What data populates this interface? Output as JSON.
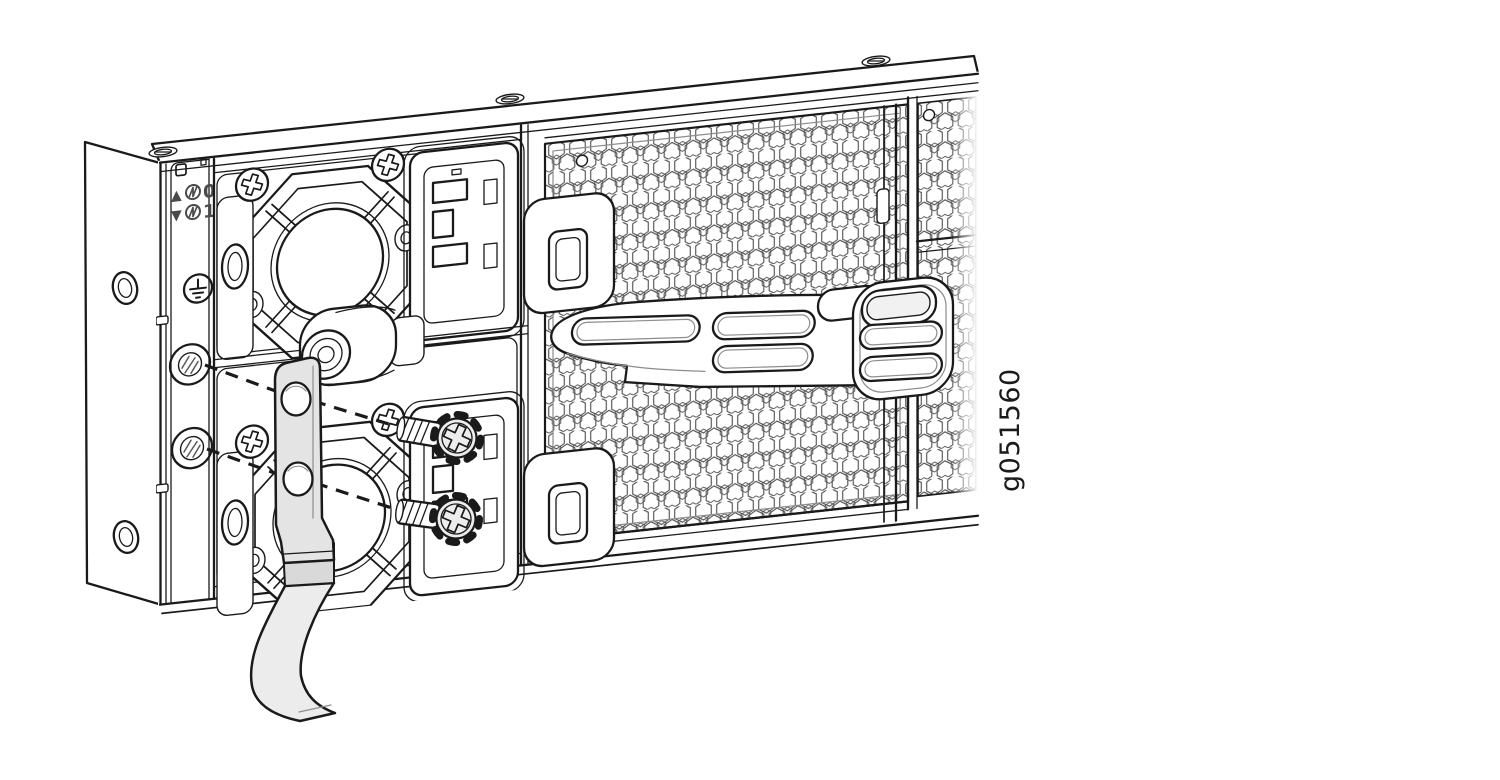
{
  "figure": {
    "graphic_id": "g051560",
    "title": "Chassis rear panel grounding-lug installation illustration",
    "background": "#ffffff"
  },
  "colors": {
    "line": "#1a1a1a",
    "soft_line": "#8d8d8d",
    "label_ink": "#4a4a4a",
    "lug_fill": "#e4e4e4",
    "cable_fill": "#ececec",
    "barrel_fill": "#d9d9d9",
    "strap_fill": "#ffffff",
    "screw_head_fill": "#ededed"
  },
  "indicators": {
    "psu0": {
      "arrow": "▲",
      "digit": "0"
    },
    "psu1": {
      "arrow": "▼",
      "digit": "1"
    }
  },
  "icons": {
    "ground": "earth-ground-icon",
    "psu_status": "circled-power-icon",
    "screws": "phillips-screw-icon"
  }
}
